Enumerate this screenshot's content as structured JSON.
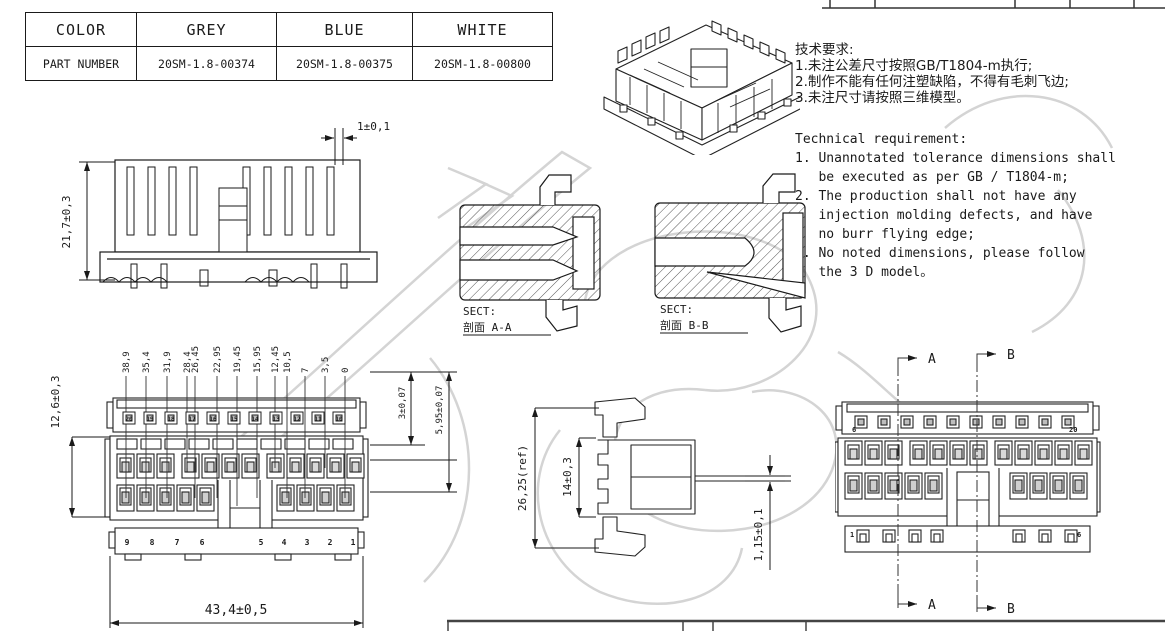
{
  "colors": {
    "line": "#1a1a1a",
    "watermark": "#d4d4d4"
  },
  "parts_table": {
    "col_header": "COLOR",
    "colors": [
      "GREY",
      "BLUE",
      "WHITE"
    ],
    "row_header": "PART NUMBER",
    "part_numbers": [
      "20SM-1.8-00374",
      "20SM-1.8-00375",
      "20SM-1.8-00800"
    ]
  },
  "notes": {
    "cn_title": "技术要求:",
    "cn_items": [
      "1.未注公差尺寸按照GB/T1804-m执行;",
      "2.制作不能有任何注塑缺陷，不得有毛刺飞边;",
      "3.未注尺寸请按照三维模型。"
    ],
    "en_title": "Technical requirement:",
    "en_items": [
      "1. Unannotated tolerance dimensions shall",
      "   be executed as per GB / T1804-m;",
      "2. The production shall not have any",
      "   injection molding defects, and have",
      "   no burr flying edge;",
      "3. No noted dimensions, please follow",
      "   the 3 D model。"
    ]
  },
  "top_view": {
    "dim_height": "21,7±0,3",
    "dim_top": "1±0,1"
  },
  "section_a": {
    "sect": "SECT:",
    "name": "剖面  A-A"
  },
  "section_b": {
    "sect": "SECT:",
    "name": "剖面  B-B"
  },
  "front_view": {
    "position_dims": [
      "38,9",
      "35,4",
      "31,9",
      "28,4",
      "26,45",
      "22,95",
      "19,45",
      "15,95",
      "12,45",
      "10,5",
      "7",
      "3,5",
      "0"
    ],
    "dim_left": "12,6±0,3",
    "dim_right_1": "3±0,07",
    "dim_right_2": "5,95±0,07",
    "dim_width": "43,4±0,5",
    "top_pins": [
      "20",
      "19",
      "18",
      "17",
      "16",
      "15",
      "14",
      "13",
      "12",
      "11",
      "10"
    ],
    "bottom_pins": [
      "9",
      "8",
      "7",
      "6",
      "5",
      "4",
      "3",
      "2",
      "1"
    ]
  },
  "side_view": {
    "dim_overall": "26,25(ref)",
    "dim_body": "14±0,3",
    "dim_pin": "1,15±0,1"
  },
  "rear_view": {
    "label_a": "A",
    "label_b": "B",
    "corner_tl": "6",
    "corner_tr": "20",
    "corner_bl": "1",
    "corner_br": "6"
  }
}
